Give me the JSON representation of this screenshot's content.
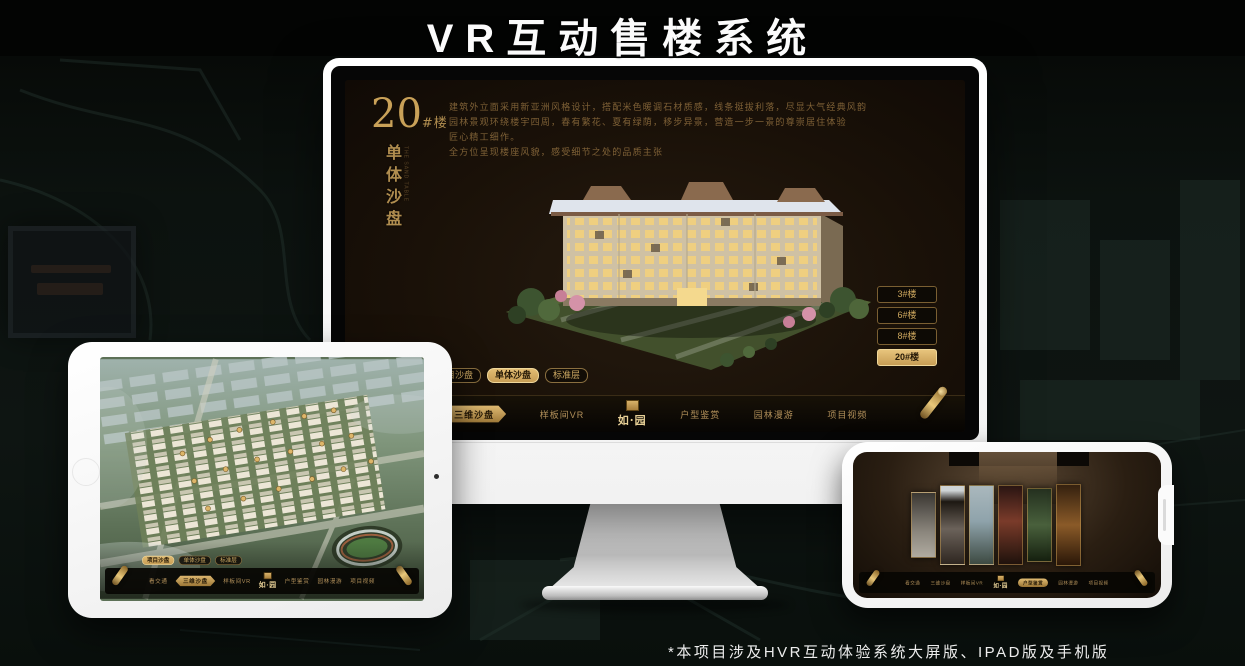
{
  "page": {
    "title": "VR互动售楼系统",
    "footnote": "*本项目涉及HVR互动体验系统大屏版、IPAD版及手机版"
  },
  "colors": {
    "gold": "#cfa95f",
    "gold_bright": "#e7c87e",
    "screen_bg": "#181009",
    "nav_bg": "#0a0705",
    "page_bg": "#0c120f"
  },
  "monitor": {
    "headline": {
      "number": "20",
      "suffix": "#楼",
      "vertical": "单体沙盘",
      "vertical_en": "THE SAND TABLE"
    },
    "description_lines": [
      "建筑外立面采用新亚洲风格设计，搭配米色暖调石材质感，线条挺拔利落，尽显大气经典风韵",
      "园林景观环绕楼宇四周，春有繁花、夏有绿荫，移步异景，营造一步一景的尊崇居住体验",
      "匠心精工细作。",
      "全方位呈现楼座风貌，感受细节之处的品质主张"
    ],
    "subtabs": [
      {
        "label": "项目沙盘",
        "active": false
      },
      {
        "label": "单体沙盘",
        "active": true
      },
      {
        "label": "标准层",
        "active": false
      }
    ],
    "building_buttons": [
      {
        "label": "3#楼",
        "active": false
      },
      {
        "label": "6#楼",
        "active": false
      },
      {
        "label": "8#楼",
        "active": false
      },
      {
        "label": "20#楼",
        "active": true
      }
    ],
    "nav_left": [
      {
        "label": "看交通",
        "active": false
      },
      {
        "label": "三维沙盘",
        "active": true
      },
      {
        "label": "样板间VR",
        "active": false
      }
    ],
    "nav_right": [
      {
        "label": "户型鉴赏",
        "active": false
      },
      {
        "label": "园林漫游",
        "active": false
      },
      {
        "label": "项目视频",
        "active": false
      }
    ],
    "logo": "如·园"
  },
  "ipad": {
    "subtabs": [
      {
        "label": "项目沙盘",
        "active": true
      },
      {
        "label": "单体沙盘",
        "active": false
      },
      {
        "label": "标准层",
        "active": false
      }
    ],
    "nav_left": [
      {
        "label": "看交通",
        "active": false
      },
      {
        "label": "三维沙盘",
        "active": true
      },
      {
        "label": "样板间VR",
        "active": false
      }
    ],
    "nav_right": [
      {
        "label": "户型鉴赏",
        "active": false
      },
      {
        "label": "园林漫游",
        "active": false
      },
      {
        "label": "项目视频",
        "active": false
      }
    ],
    "logo": "如·园"
  },
  "phone": {
    "nav_left": [
      {
        "label": "看交通",
        "active": false
      },
      {
        "label": "三维沙盘",
        "active": false
      },
      {
        "label": "样板间VR",
        "active": false
      }
    ],
    "nav_right": [
      {
        "label": "户型鉴赏",
        "active": true
      },
      {
        "label": "园林漫游",
        "active": false
      },
      {
        "label": "项目视频",
        "active": false
      }
    ],
    "logo": "如·园"
  }
}
